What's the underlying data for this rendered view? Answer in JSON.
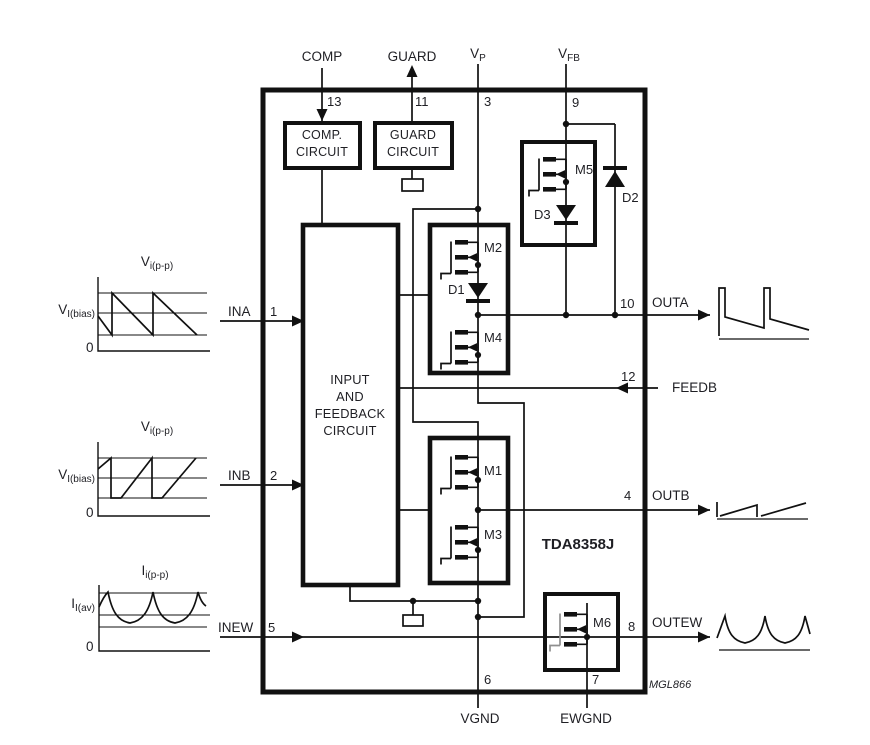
{
  "chip": {
    "part_number": "TDA8358J",
    "drawing_code": "MGL866"
  },
  "top_pins": {
    "comp": {
      "label": "COMP",
      "number": "13"
    },
    "guard": {
      "label": "GUARD",
      "number": "11"
    },
    "vp": {
      "base": "V",
      "sub": "P",
      "number": "3"
    },
    "vfb": {
      "base": "V",
      "sub": "FB",
      "number": "9"
    }
  },
  "left_pins": {
    "ina": {
      "label": "INA",
      "number": "1"
    },
    "inb": {
      "label": "INB",
      "number": "2"
    },
    "inew": {
      "label": "INEW",
      "number": "5"
    }
  },
  "right_pins": {
    "outa": {
      "label": "OUTA",
      "number": "10"
    },
    "feedb": {
      "label": "FEEDB",
      "number": "12"
    },
    "outb": {
      "label": "OUTB",
      "number": "4"
    },
    "outew": {
      "label": "OUTEW",
      "number": "8"
    }
  },
  "bottom_pins": {
    "vgnd": {
      "label": "VGND",
      "number": "6"
    },
    "ewgnd": {
      "label": "EWGND",
      "number": "7"
    }
  },
  "blocks": {
    "comp_circuit": {
      "line1": "COMP.",
      "line2": "CIRCUIT"
    },
    "guard_circuit": {
      "line1": "GUARD",
      "line2": "CIRCUIT"
    },
    "input_feedback": {
      "line1": "INPUT",
      "line2": "AND",
      "line3": "FEEDBACK",
      "line4": "CIRCUIT"
    }
  },
  "devices": {
    "m1": "M1",
    "m2": "M2",
    "m3": "M3",
    "m4": "M4",
    "m5": "M5",
    "m6": "M6",
    "d1": "D1",
    "d2": "D2",
    "d3": "D3"
  },
  "waveforms": {
    "ina": {
      "title_base": "V",
      "title_sub": "i(p-p)",
      "level_base": "V",
      "level_sub": "I(bias)",
      "zero": "0"
    },
    "inb": {
      "title_base": "V",
      "title_sub": "i(p-p)",
      "level_base": "V",
      "level_sub": "I(bias)",
      "zero": "0"
    },
    "inew": {
      "title_base": "I",
      "title_sub": "i(p-p)",
      "level_base": "I",
      "level_sub": "I(av)",
      "zero": "0"
    }
  },
  "colors": {
    "line": "#111111",
    "text": "#1f1f24",
    "gray_gate": "#8f8f8f"
  }
}
